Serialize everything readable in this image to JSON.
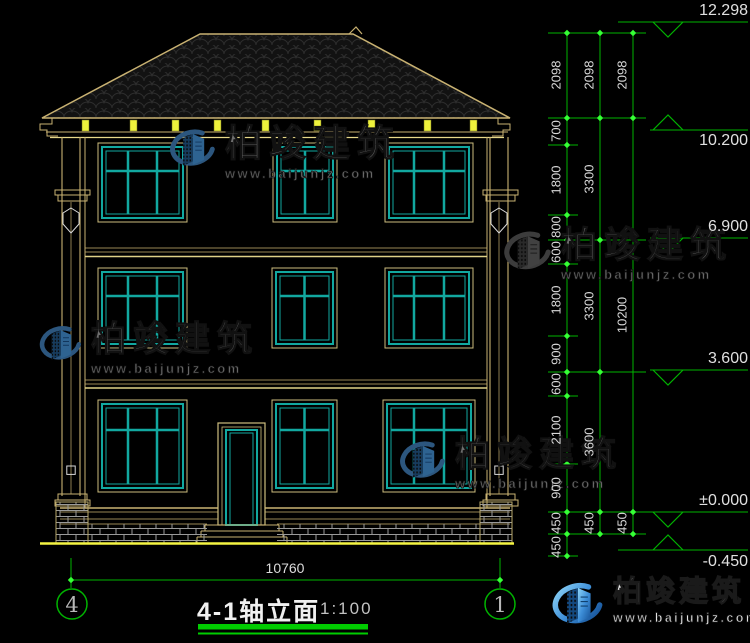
{
  "watermark": {
    "brand": "柏竣建筑",
    "url": "www.baijunjz.com"
  },
  "title": {
    "name": "4-1轴立面",
    "scale": "1:100"
  },
  "bottom_dim": {
    "label": "10760",
    "axis_left": "4",
    "axis_right": "1"
  },
  "elevations": [
    {
      "label": "12.298"
    },
    {
      "label": "10.200"
    },
    {
      "label": "6.900"
    },
    {
      "label": "3.600"
    },
    {
      "label": "±0.000"
    },
    {
      "label": "-0.450"
    }
  ],
  "dim_chains": {
    "inner": [
      "2098",
      "700",
      "1800",
      "800",
      "600",
      "1800",
      "900",
      "600",
      "2100",
      "900",
      "450",
      "450"
    ],
    "middle": [
      "2098",
      "3300",
      "3300",
      "3600",
      "450"
    ],
    "outer": [
      "2098",
      "10200",
      "450"
    ]
  },
  "colors": {
    "dim_green": "#00b400",
    "tick_green": "#35ff35",
    "line_tan": "#c9b272",
    "bright_yellow": "#f4f442",
    "window_teal": "#12a8a0",
    "logo_blue": "#3d8ed8"
  }
}
